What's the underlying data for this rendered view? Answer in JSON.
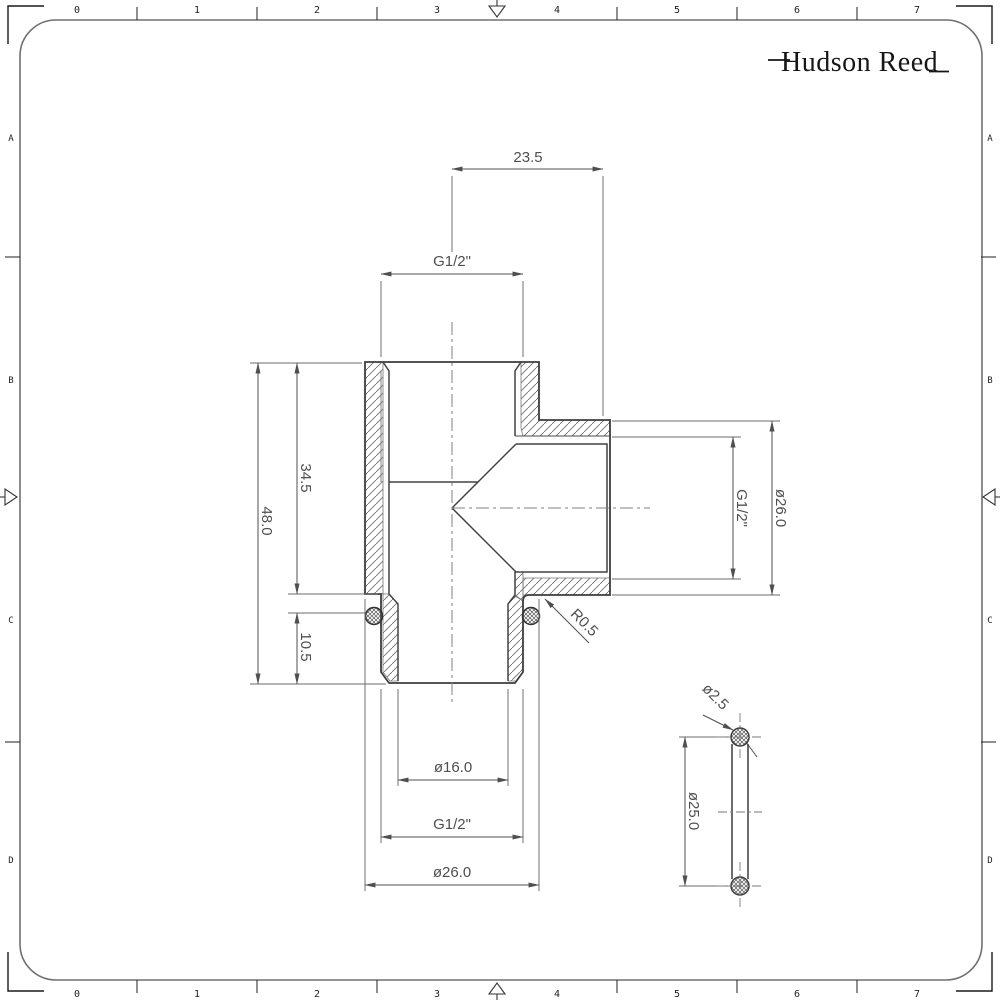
{
  "brand": {
    "name": "Hudson Reed"
  },
  "frame": {
    "ruler_numbers": [
      "0",
      "1",
      "2",
      "3",
      "4",
      "5",
      "6",
      "7"
    ],
    "row_letters": [
      "A",
      "B",
      "C",
      "D"
    ]
  },
  "drawing": {
    "type": "sectioned tee fitting",
    "dimensions": {
      "branch_offset": "23.5",
      "thread_top": "G1/2\"",
      "socket_depth": "34.5",
      "body_height": "48.0",
      "oring_offset": "10.5",
      "thread_branch": "G1/2\"",
      "branch_od": "ø26.0",
      "bore_diameter": "ø16.0",
      "thread_bottom": "G1/2\"",
      "body_od": "ø26.0",
      "fillet_radius": "R0.5",
      "oring_cross_section": "ø2.5",
      "oring_diameter": "ø25.0"
    }
  },
  "colors": {
    "line_dark": "#3d3d3d",
    "line_thin": "#6f6f6f",
    "dim_text": "#4f4f4f",
    "background": "#ffffff"
  }
}
